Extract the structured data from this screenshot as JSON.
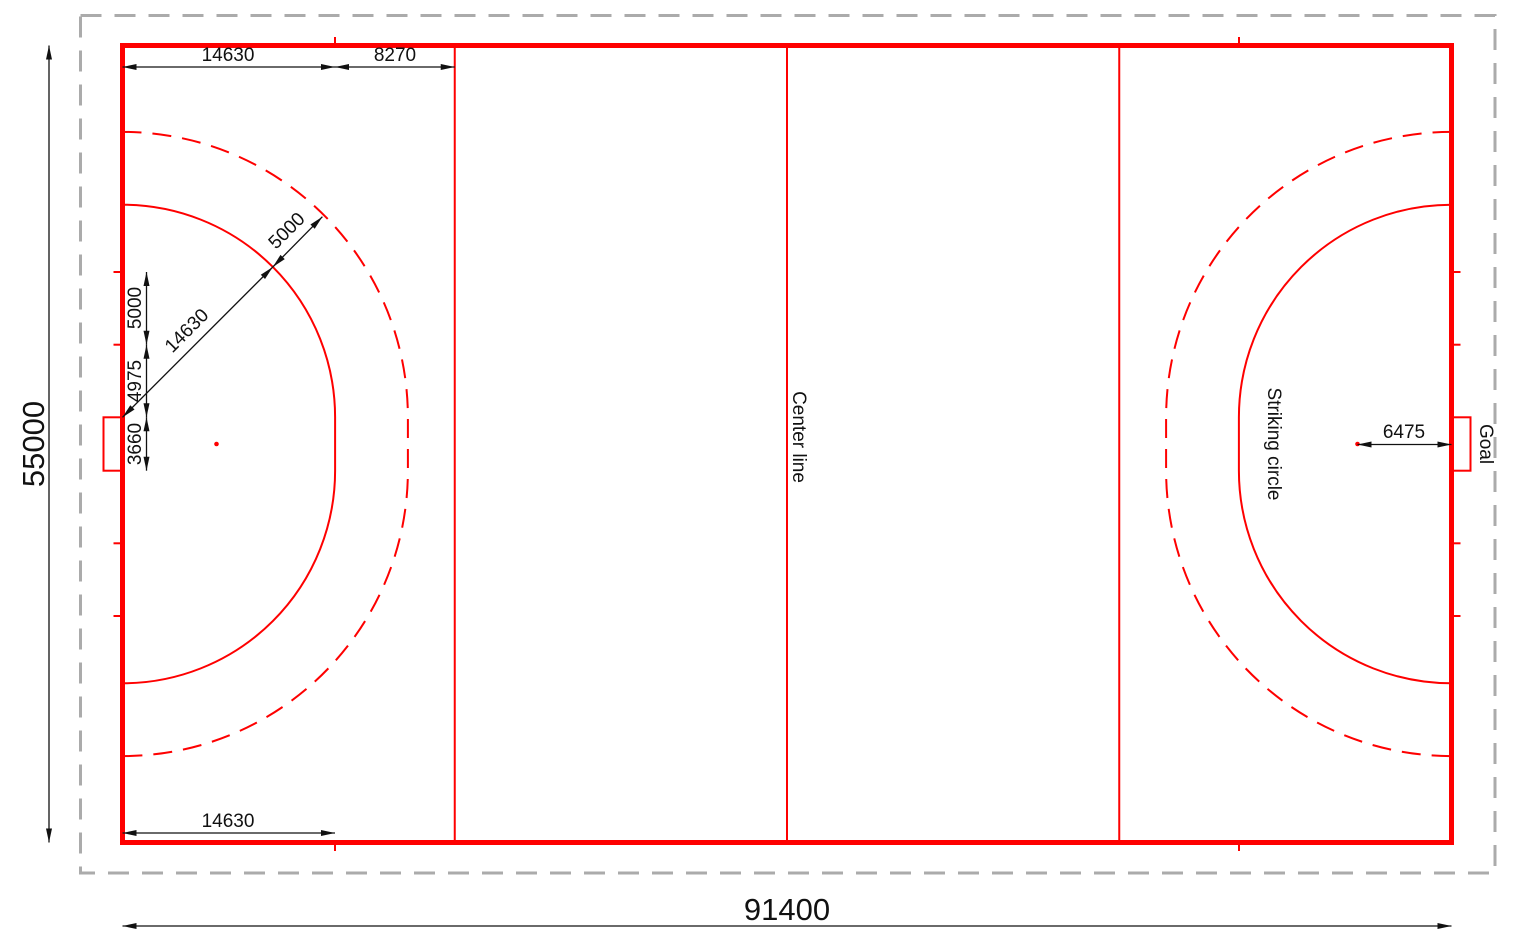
{
  "drawing": {
    "subject": "Field hockey pitch marking plan",
    "units": "mm",
    "colors": {
      "pitch_lines": "#fe0000",
      "surround_boundary": "#ababab",
      "dimension_lines": "#111111"
    },
    "labels": {
      "center_line": "Center line",
      "striking_circle": "Striking circle",
      "goal": "Goal"
    },
    "dims": {
      "pitch_length": "91400",
      "pitch_width": "55000",
      "top_circle_tangent": "14630",
      "top_circle_to_23m_line": "8270",
      "diag_circle_radius": "14630",
      "diag_broken_offset": "5000",
      "backline_mark_10m": "5000",
      "backline_mark_5m": "4975",
      "goal_width": "3660",
      "penalty_spot_distance": "6475",
      "bottom_circle_tangent": "14630"
    }
  }
}
